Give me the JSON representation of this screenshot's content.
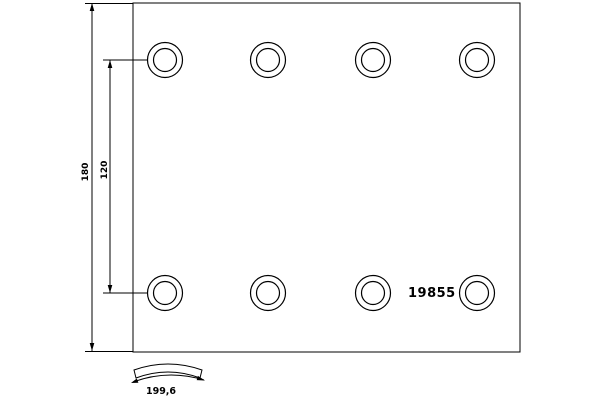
{
  "drawing": {
    "part_number": "19855",
    "dimensions": {
      "overall_height": "180",
      "hole_row_spacing": "120",
      "arc_width": "199,6"
    },
    "holes": {
      "rows": 2,
      "columns": 4,
      "total": 8
    },
    "colors": {
      "line": "#000000",
      "background": "#ffffff"
    }
  }
}
